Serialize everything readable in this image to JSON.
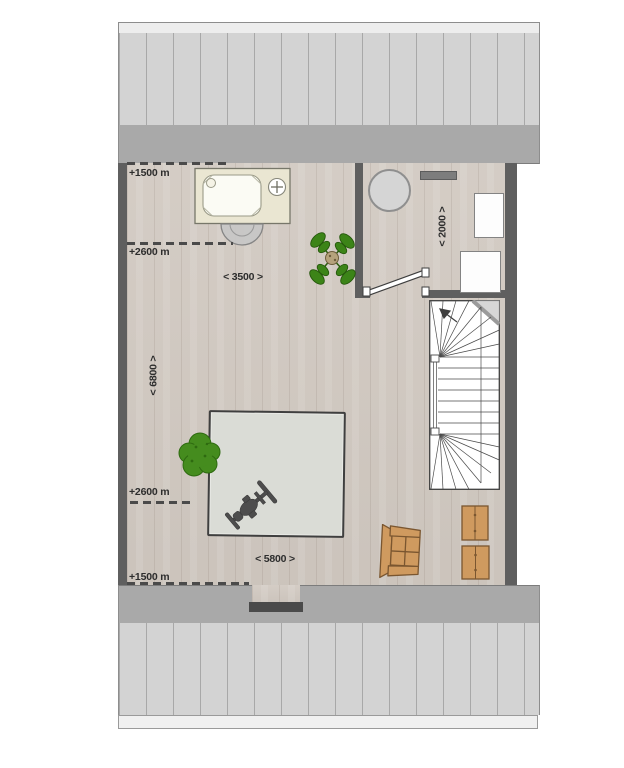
{
  "plan": {
    "title": "attic-floor-plan",
    "annotations": {
      "top_left_upper": "+1500 m",
      "top_left_lower": "+2600 m",
      "bottom_left_upper": "+2600 m",
      "bottom_left_lower": "+1500 m",
      "width_top": "< 3500 >",
      "width_bottom": "< 5800 >",
      "height_left": "< 6800 >",
      "height_right": "< 2000 >"
    },
    "icons": [
      "bathtub-icon",
      "shower-step-icon",
      "round-table-icon",
      "wall-vent-icon",
      "cabinet-icon",
      "door-leaf-icon",
      "staircase-icon",
      "stair-direction-arrow-icon",
      "potted-plant-icon",
      "bush-icon",
      "rug-icon",
      "exercise-bike-icon",
      "armchair-icon",
      "storage-box-icon",
      "dormer-window-icon"
    ],
    "colors": {
      "wall": "#5f5f5f",
      "roof_panel": "#d3d3d3",
      "roof_eave": "#a9a9a9",
      "roof_ridge": "#ededed",
      "floor_wood": "#d2cac2",
      "rug": "#dadcd6",
      "plant_green": "#3f8b1d",
      "furniture_tan": "#cf9a5f",
      "stair_fill": "#ffffff",
      "text": "#2d2d2d"
    }
  }
}
